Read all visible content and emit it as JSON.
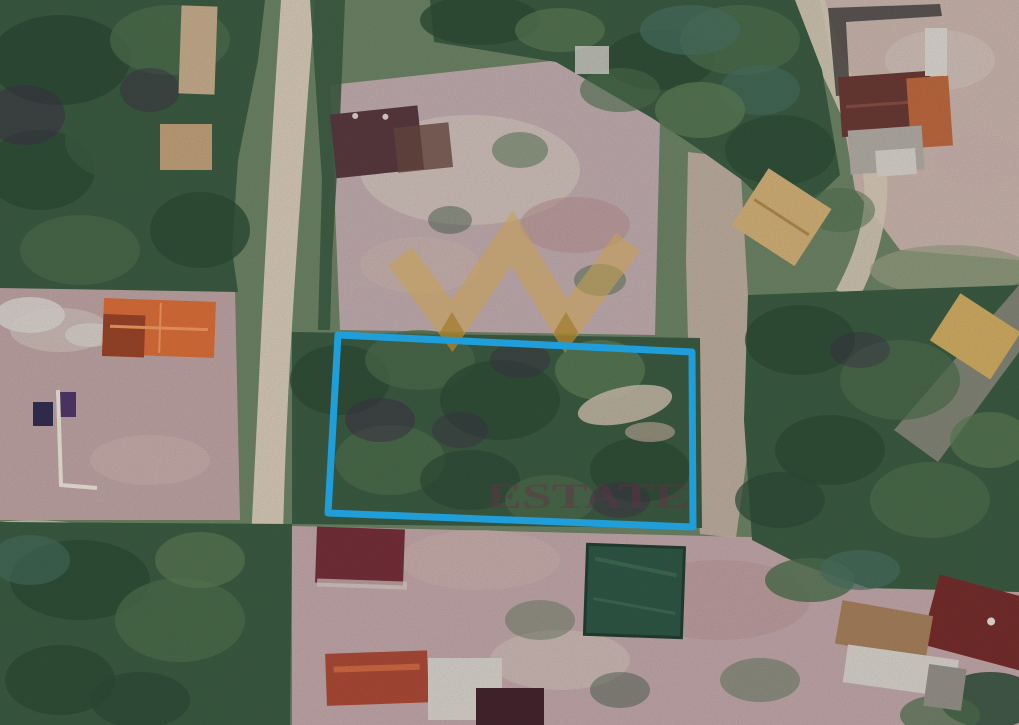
{
  "watermark": {
    "crown_icon": "crown-icon",
    "text": "ESTATE",
    "crown_points": "400,256 452,326 512,238 566,326 628,242",
    "crown_color": "#c9a14e",
    "crown_opacity": "0.55",
    "tip_color": "#9c7420",
    "tip_opacity": "0.6",
    "text_color": "rgba(104,48,70,0.45)"
  },
  "annotation": {
    "boundary_points": "338,335 692,352 693,527 328,513",
    "boundary_color": "#1f9ed9",
    "boundary_width": "7"
  },
  "palette": {
    "base_green": "#6e8566",
    "road": "#d8cbb8",
    "dirt_strip": "#c6b2a6",
    "clearing_top": "#c2adb0",
    "clearing_left": "#c0a5a5",
    "clearing_bottom": "#c3a8ab",
    "clearing_topright": "#cbb6ae",
    "pond": "#2f5847",
    "roof_orange": "#dd6f3a",
    "roof_orange_dark": "#9c4529",
    "roof_red_dark": "#76303a",
    "roof_maroon": "#5a3a41",
    "roof_brown_red": "#6b3a35",
    "roof_tan": "#d4b279",
    "roof_burnt": "#ad4b38",
    "white_roof": "#d9d4cd"
  }
}
